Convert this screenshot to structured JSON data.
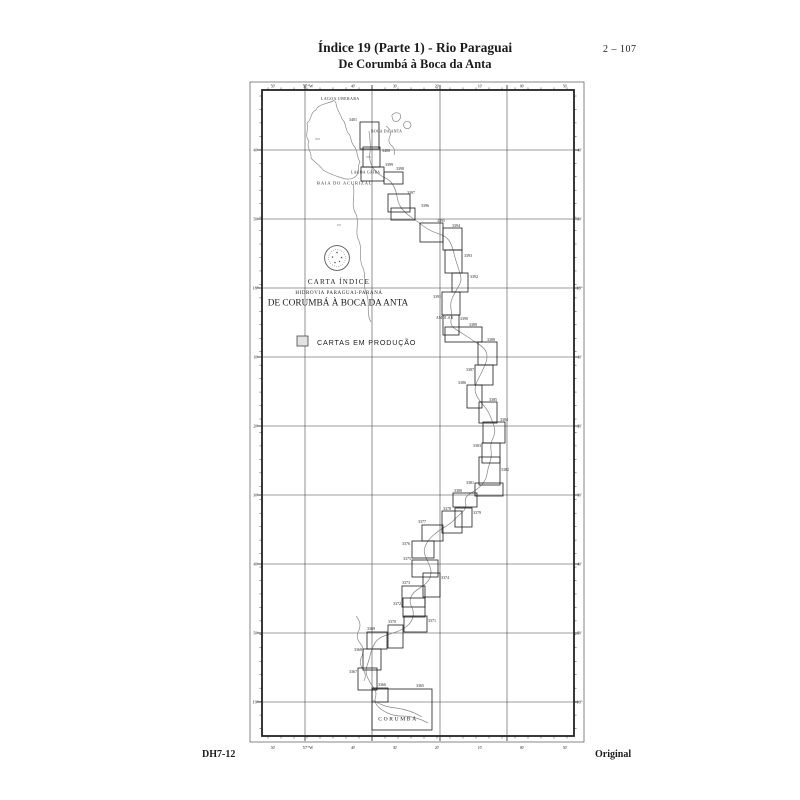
{
  "page": {
    "header": {
      "title_line1": "Índice 19 (Parte 1) - Rio Paraguai",
      "title_line2": "De Corumbá à Boca da Anta",
      "page_number": "2 – 107"
    },
    "footer": {
      "left": "DH7-12",
      "right": "Original"
    }
  },
  "map": {
    "index_block": {
      "carta_indice": "CARTA ÍNDICE",
      "hidrovia": "HIDROVIA PARAGUAI-PARANÁ",
      "trecho": "DE CORUMBÁ À BOCA DA ANTA"
    },
    "legend": {
      "label": "CARTAS EM PRODUÇÃO"
    },
    "places": {
      "lagoa_uberaba": "LAGOA UBERABA",
      "boca_da_anta": "BOCA DA ANTA",
      "lagoa_gaiba": "LAGOA GAÍBA",
      "baia_do_acurizal": "BAIA DO ACURIZAL",
      "amolar": "AMOLAR",
      "corumba": "CORUMBÁ"
    },
    "axis": {
      "top_ticks": [
        "50'",
        "57°W",
        "40'",
        "30'",
        "20'",
        "10'",
        "00'",
        "50'"
      ],
      "bottom_ticks": [
        "50'",
        "57°W",
        "40'",
        "30'",
        "20'",
        "10'",
        "00'",
        "50'"
      ],
      "left_ticks": [
        "40'",
        "50'",
        "18°",
        "10'",
        "20'",
        "30'",
        "40'",
        "50'",
        "19°"
      ],
      "right_ticks": [
        "40'",
        "50'",
        "18°",
        "10'",
        "20'",
        "30'",
        "40'",
        "50'",
        "19°"
      ]
    },
    "charts": [
      {
        "num": "3401"
      },
      {
        "num": "3400"
      },
      {
        "num": "3399"
      },
      {
        "num": "3398"
      },
      {
        "num": "3397"
      },
      {
        "num": "3396"
      },
      {
        "num": "3395"
      },
      {
        "num": "3394"
      },
      {
        "num": "3393"
      },
      {
        "num": "3392"
      },
      {
        "num": "3391"
      },
      {
        "num": "3390"
      },
      {
        "num": "3389"
      },
      {
        "num": "3388"
      },
      {
        "num": "3387"
      },
      {
        "num": "3386"
      },
      {
        "num": "3385"
      },
      {
        "num": "3384"
      },
      {
        "num": "3383"
      },
      {
        "num": "3382"
      },
      {
        "num": "3381"
      },
      {
        "num": "3380"
      },
      {
        "num": "3379"
      },
      {
        "num": "3378"
      },
      {
        "num": "3377"
      },
      {
        "num": "3376"
      },
      {
        "num": "3375"
      },
      {
        "num": "3374"
      },
      {
        "num": "3373"
      },
      {
        "num": "3372"
      },
      {
        "num": "3371"
      },
      {
        "num": "3370"
      },
      {
        "num": "3369"
      },
      {
        "num": "3368"
      },
      {
        "num": "3367"
      },
      {
        "num": "3366"
      },
      {
        "num": "3365"
      }
    ]
  },
  "colors": {
    "ink": "#1c1c1c",
    "frame": "#222222",
    "grid": "#3a3a3a",
    "water": "#8a8a8a",
    "legend_fill": "#e3e3e3"
  }
}
